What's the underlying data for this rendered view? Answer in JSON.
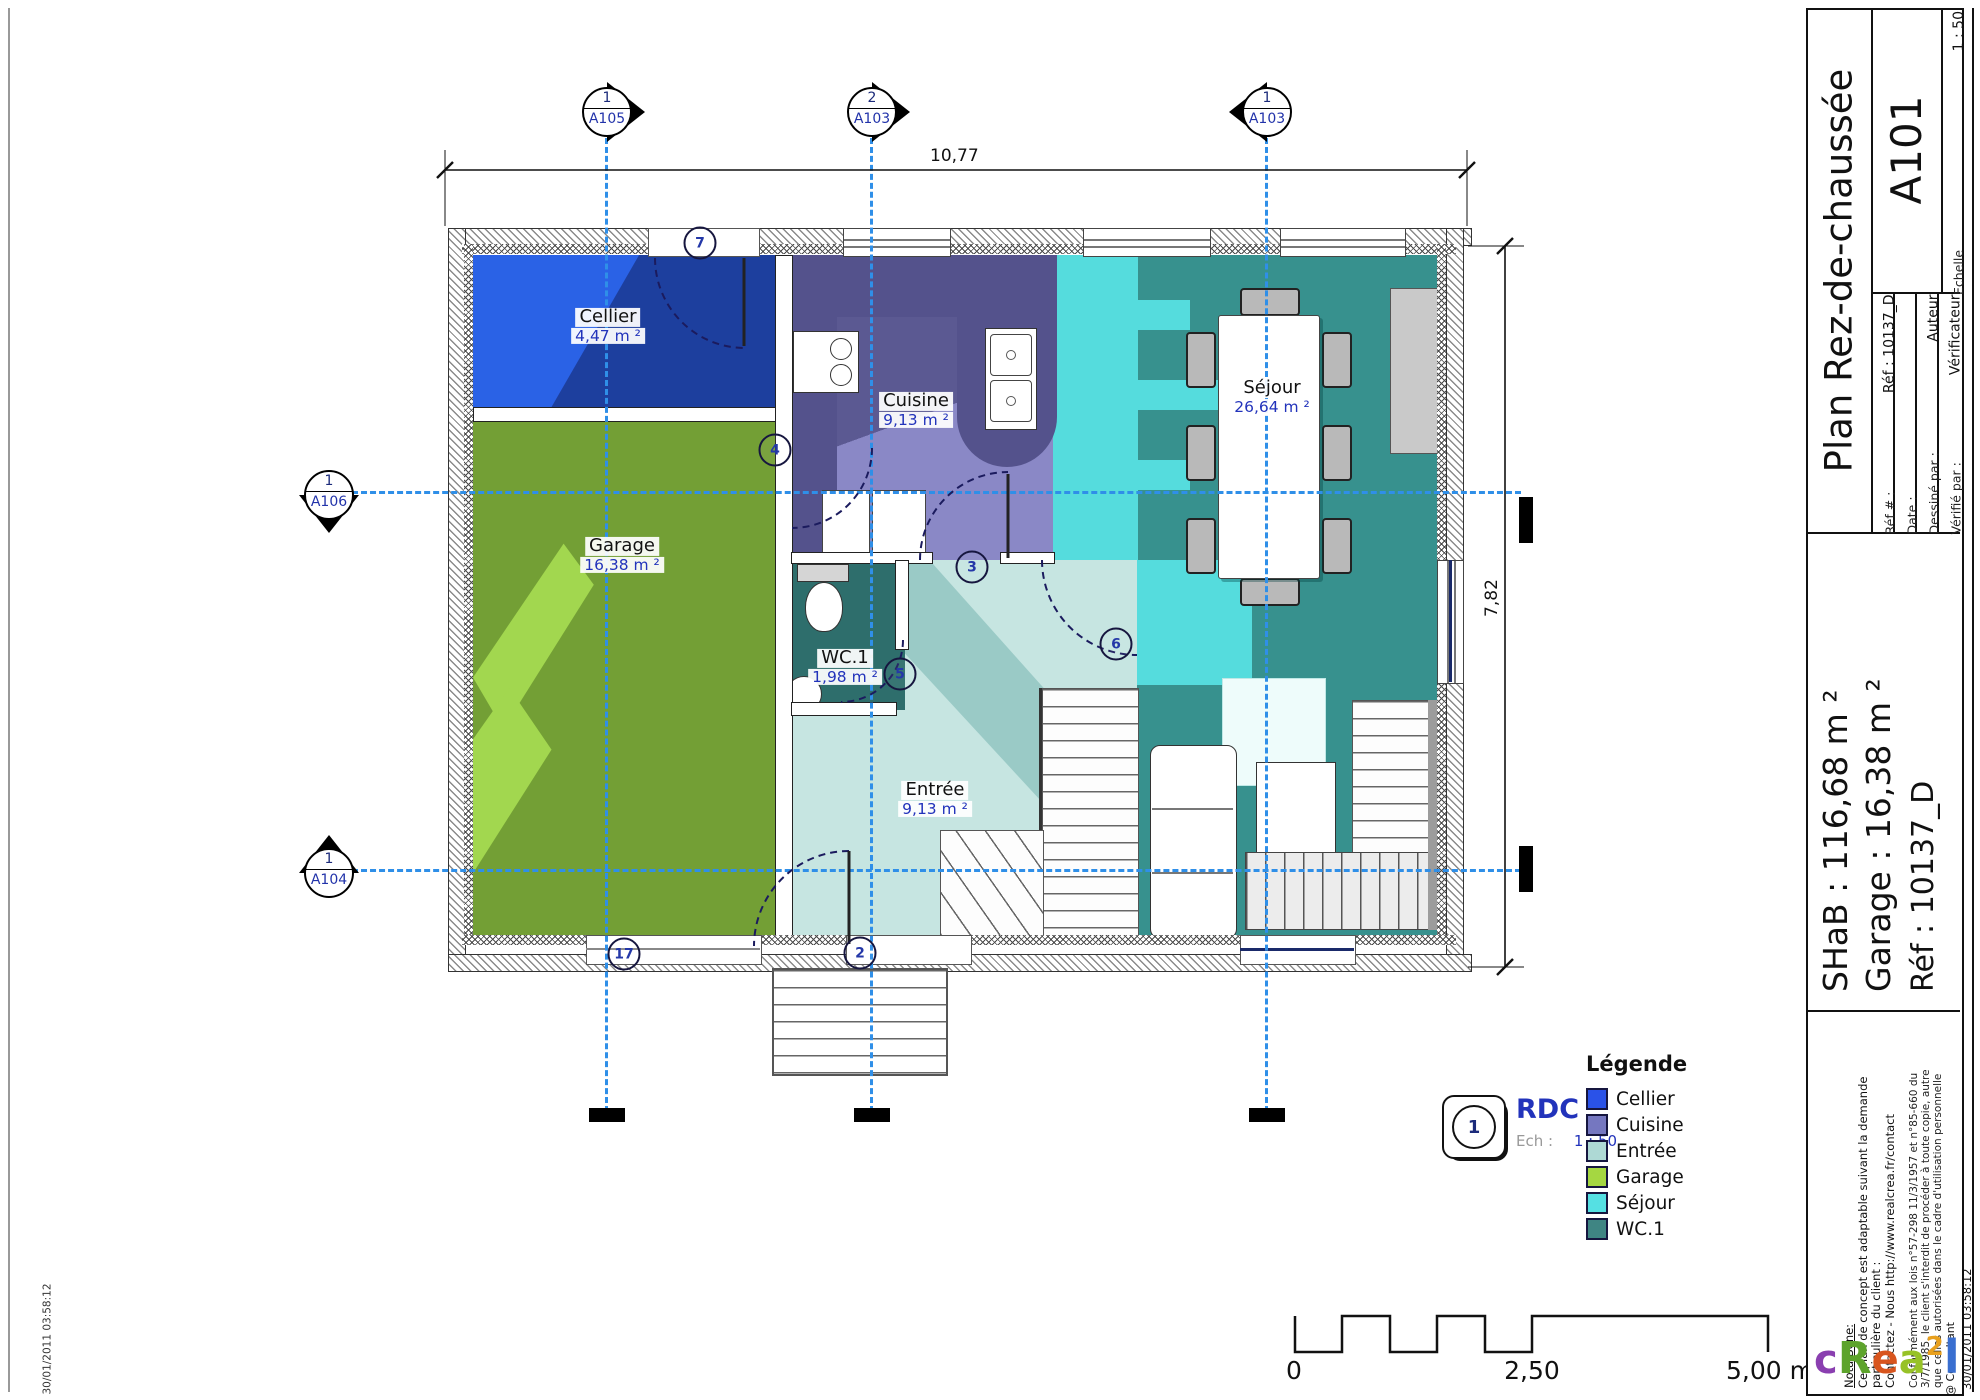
{
  "title_block": {
    "title": "Plan Rez-de-chaussée",
    "sheet_number": "A101",
    "fields": [
      {
        "label": "Réf # :",
        "value": "Réf : 10137_D"
      },
      {
        "label": "Date :",
        "value": ""
      },
      {
        "label": "Dessiné par :",
        "value": "Auteur"
      },
      {
        "label": "Vérifié par :",
        "value": "Vérificateur"
      }
    ],
    "scale_label": "Echelle",
    "scale_value": "1 : 50",
    "summary": {
      "shab": "SHaB : 116,68 m ²",
      "garage": "Garage : 16,38 m ²",
      "ref": "Réf : 10137_D"
    },
    "nota": {
      "heading": "Nota Bene:",
      "line1": "Ce plan de concept est adaptable suivant la demande",
      "line2": "particulière du client :",
      "line3": "Contactez - Nous http://www.realcrea.fr/contact",
      "legal1": "Conformément aux lois n°57-298 11/3/1957 et n°85-660 du",
      "legal2": "3/7/1985, le client s'interdit de procéder à toute copie, autre",
      "legal3": "que celles autorisées dans le cadre d'utilisation personnelle",
      "consultant": "@ Consultant",
      "date_stamp_right": "30/01/2011 03:58:12",
      "date_stamp_left": "30/01/2011 03:58:12"
    },
    "logo_letters": [
      {
        "ch": "c",
        "color": "#8a3fb0"
      },
      {
        "ch": "R",
        "color": "#5da32c"
      },
      {
        "ch": "e",
        "color": "#d8551e"
      },
      {
        "ch": "a",
        "color": "#97c227"
      },
      {
        "ch": "2",
        "color": "#e8a01e"
      },
      {
        "ch": "l",
        "color": "#3a6fd0"
      }
    ]
  },
  "plan": {
    "rooms": [
      {
        "name": "Cellier",
        "area": "4,47 m ²"
      },
      {
        "name": "Cuisine",
        "area": "9,13 m ²"
      },
      {
        "name": "Séjour",
        "area": "26,64 m ²"
      },
      {
        "name": "Garage",
        "area": "16,38 m ²"
      },
      {
        "name": "WC.1",
        "area": "1,98 m ²"
      },
      {
        "name": "Entrée",
        "area": "9,13 m ²"
      }
    ],
    "grid_markers": {
      "top": [
        {
          "number": "1",
          "sheet": "A105"
        },
        {
          "number": "2",
          "sheet": "A103"
        },
        {
          "number": "1",
          "sheet": "A103"
        }
      ],
      "left": [
        {
          "number": "1",
          "sheet": "A106"
        },
        {
          "number": "1",
          "sheet": "A104"
        }
      ]
    },
    "dimensions": {
      "width": "10,77",
      "height": "7,82"
    },
    "door_tags": [
      "7",
      "4",
      "3",
      "5",
      "6",
      "2",
      "17"
    ]
  },
  "legend": {
    "title": "Légende",
    "items": [
      {
        "label": "Cellier",
        "color": "#2a52e8"
      },
      {
        "label": "Cuisine",
        "color": "#7577c0"
      },
      {
        "label": "Entrée",
        "color": "#aed9d5"
      },
      {
        "label": "Garage",
        "color": "#a5d741"
      },
      {
        "label": "Séjour",
        "color": "#55e0e3"
      },
      {
        "label": "WC.1",
        "color": "#3f8583"
      }
    ]
  },
  "view_marker": {
    "number": "1",
    "label": "RDC",
    "scale_label": "Ech :",
    "scale_value": "1 : 50"
  },
  "scale_bar": {
    "start": "0",
    "middle": "2,50",
    "end": "5,00 m"
  }
}
